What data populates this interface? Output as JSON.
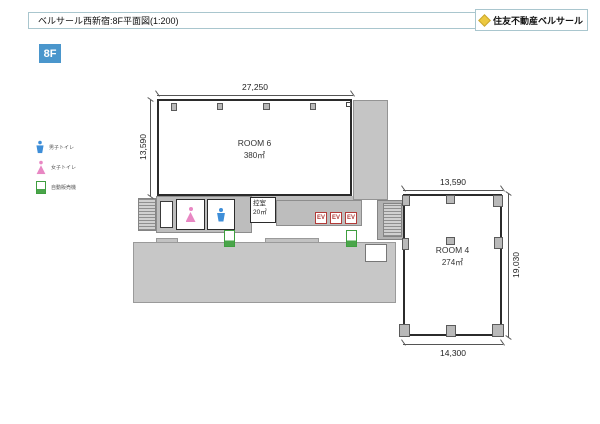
{
  "header": {
    "title": "ベルサール西新宿:8F平面図(1:200)",
    "brand": "住友不動産ベルサール"
  },
  "floor_badge": "8F",
  "legend": {
    "items": [
      {
        "icon": "male-toilet-icon",
        "label": "男子トイレ"
      },
      {
        "icon": "female-toilet-icon",
        "label": "女子トイレ"
      },
      {
        "icon": "vending-machine-icon",
        "label": "自動販売機"
      }
    ]
  },
  "floor_plan": {
    "room6": {
      "name": "ROOM 6",
      "area": "380㎡",
      "dim_width": "27,250",
      "dim_height": "13,590"
    },
    "room4": {
      "name": "ROOM 4",
      "area": "274㎡",
      "dim_top": "13,590",
      "dim_right": "19,030",
      "dim_bottom": "14,300"
    },
    "waiting_room": {
      "name": "控室",
      "area": "20㎡"
    },
    "elevators": [
      "EV",
      "EV",
      "EV"
    ]
  },
  "colors": {
    "accent_blue": "#4a96cc",
    "header_border": "#a9c6ce",
    "male_icon": "#3e8ed8",
    "female_icon": "#e887c3",
    "vending_green": "#3f9e3f",
    "elevator_red": "#b23b38",
    "brand_gold": "#ecc83f"
  }
}
